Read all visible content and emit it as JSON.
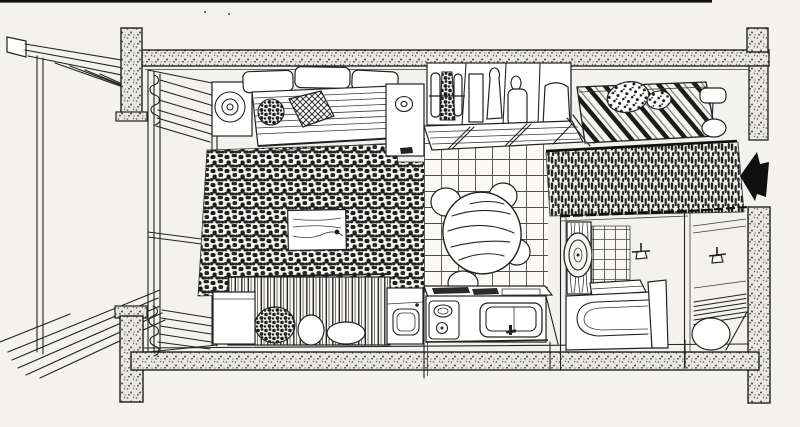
{
  "meta": {
    "kind": "hand-drawn cutaway axonometric floor plan",
    "subject": "studio apartment interior, ink sketch on paper",
    "text_in_image": "none"
  },
  "colors": {
    "paper": "#f3f2ef",
    "ink": "#222222",
    "ink_dark": "#111111",
    "wall_fill": "#e9e7e2",
    "white": "#ffffff",
    "arrow": "#101010"
  },
  "structure": {
    "elements": [
      "top concrete beam",
      "bottom concrete beam",
      "four corner columns with footings",
      "entrance opening in right wall"
    ]
  },
  "entrance": {
    "indicator": "solid black arrow pointing left into entry opening"
  },
  "window_wall": {
    "position": "left interior",
    "features": [
      "full-height window frame",
      "gathered curtain top",
      "gathered curtain bottom"
    ]
  },
  "areas": [
    {
      "name": "balcony",
      "position": "left exterior",
      "features": [
        "sloped railing",
        "vertical rail posts",
        "diagonal plank floor"
      ]
    },
    {
      "name": "living-area",
      "position": "center-left",
      "floor": "dense shag rug",
      "furniture": [
        "three-seat sofa",
        "spiral cushion on armrest",
        "hatched square pillow",
        "speckled round pillow",
        "side cabinet with round opening",
        "low table on rug",
        "futon bed with striped drape",
        "speckled pillow",
        "two white pillows",
        "nightstand"
      ]
    },
    {
      "name": "wardrobe",
      "position": "top center",
      "furniture": [
        "open closet with four bays",
        "hanging clothes",
        "slatted bench with diagonal braces",
        "open door panel"
      ]
    },
    {
      "name": "sleeping-corner",
      "position": "top right",
      "furniture": [
        "bed with diagonal striped cover",
        "two polka-dot pillows",
        "bedside lamp table"
      ]
    },
    {
      "name": "hallway",
      "position": "right of dining area",
      "floor": "dark pile carpet runner"
    },
    {
      "name": "kitchen-dining",
      "position": "center",
      "floor": "square tile grid",
      "furniture": [
        "round wood-grain dining table",
        "four round stools",
        "kitchen counter",
        "two-burner stove",
        "sink with faucet",
        "washing machine with round door"
      ]
    },
    {
      "name": "bathroom",
      "position": "bottom right",
      "furniture": [
        "bathtub",
        "oval mirror",
        "striped shower panel",
        "tiled wall",
        "wall faucet fixture",
        "raised tub rim"
      ]
    },
    {
      "name": "entry",
      "position": "bottom far right",
      "furniture": [
        "wall hook fixture",
        "slatted duckboard floor",
        "round basin stool"
      ]
    }
  ]
}
